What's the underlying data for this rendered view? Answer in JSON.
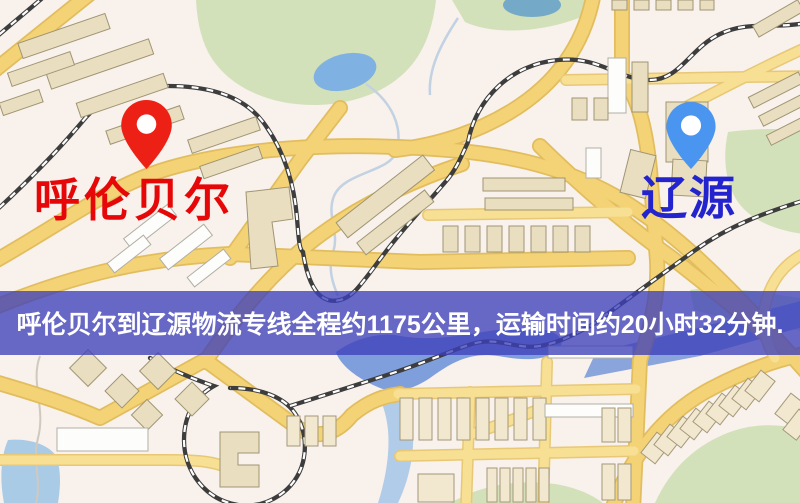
{
  "map": {
    "origin": {
      "label": "呼伦贝尔",
      "pin_color": "#ed2015",
      "label_color": "#e60808"
    },
    "destination": {
      "label": "辽源",
      "pin_color": "#4a95f0",
      "label_color": "#2424cf"
    },
    "banner": {
      "text": "呼伦贝尔到辽源物流专线全程约1175公里，运输时间约20小时32分钟.",
      "distance_km": 1175,
      "duration_text": "20小时32分钟",
      "background": "rgba(62,64,186,0.78)",
      "text_color": "#ffffff"
    },
    "palette": {
      "map_background": "#f8f1ec",
      "road_fill": "#f3d376",
      "road_casing": "#e2bd5e",
      "minor_road_fill": "#f7e093",
      "building_fill": "#e9dec0",
      "building_white": "#fdfdfb",
      "park_green": "#d3e1ba",
      "water_blue": "#7fb2e2",
      "river_blue": "#7e9fdc",
      "railway_dark": "#3d3d3d"
    }
  }
}
